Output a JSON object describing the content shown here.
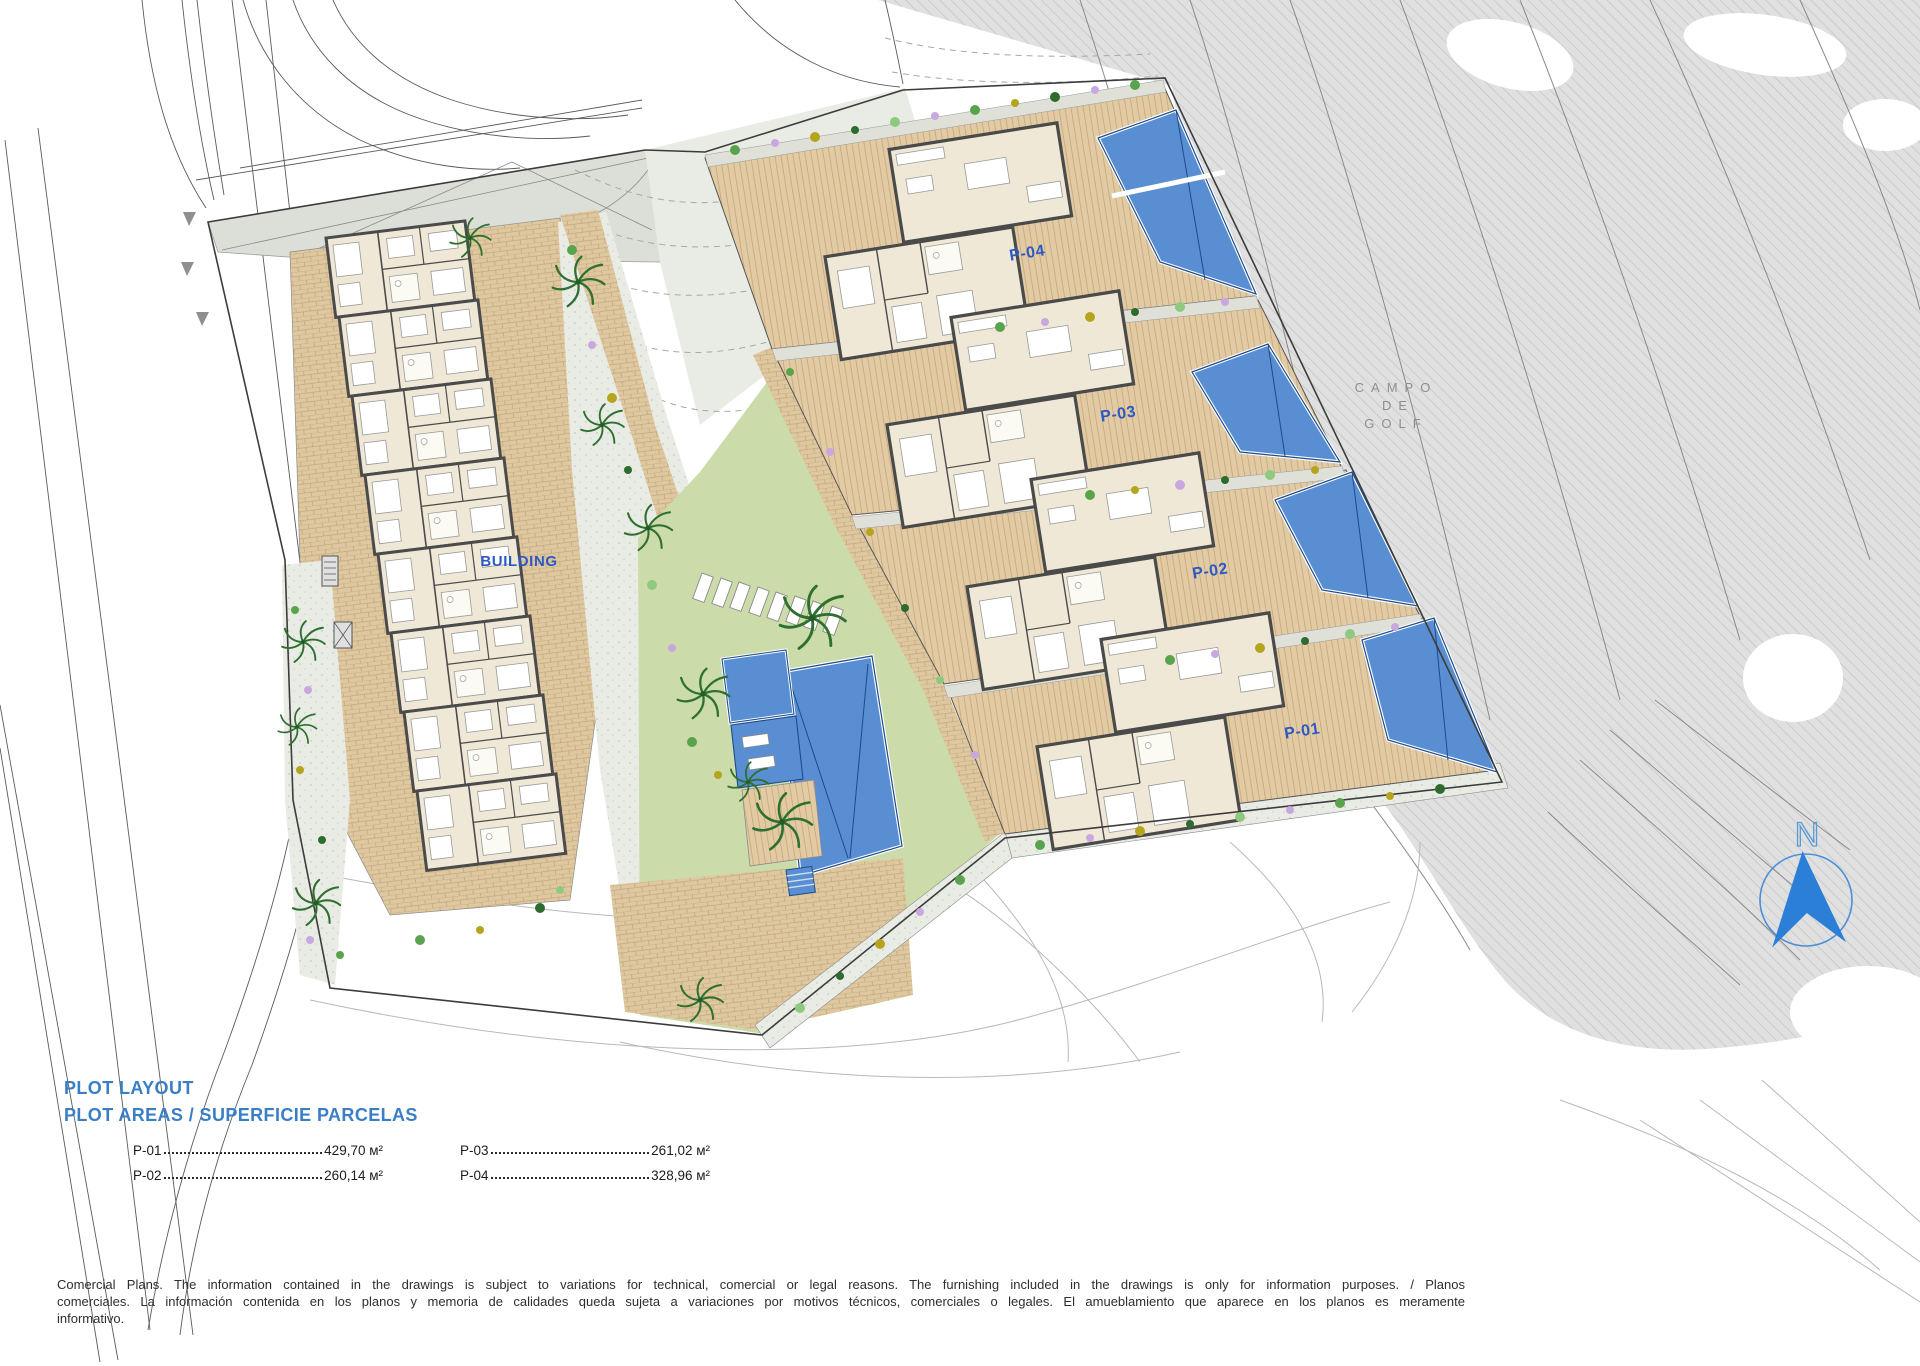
{
  "plan": {
    "building_label": "BUILDING",
    "plot_labels": [
      "P-04",
      "P-03",
      "P-02",
      "P-01"
    ],
    "golf_label": {
      "line1": "CAMPO",
      "line2": "DE",
      "line3": "GOLF"
    },
    "north_label": "N"
  },
  "legend": {
    "title": "PLOT LAYOUT",
    "subtitle": "PLOT AREAS / SUPERFICIE PARCELAS",
    "columns": [
      {
        "rows": [
          {
            "plot": "P-01",
            "area": "429,70 м²"
          },
          {
            "plot": "P-02",
            "area": "260,14 м²"
          }
        ]
      },
      {
        "rows": [
          {
            "plot": "P-03",
            "area": "261,02 м²"
          },
          {
            "plot": "P-04",
            "area": "328,96 м²"
          }
        ]
      }
    ]
  },
  "footer": {
    "disclaimer": "Comercial Plans. The information contained in the drawings is subject to variations for technical, comercial or legal reasons. The furnishing included in the drawings is only for information purposes. / Planos comerciales. La información contenida en los planos y memoria de calidades queda sujeta a variaciones por motivos técnicos, comerciales o legales. El amueblamiento que aparece en los planos es meramente informativo."
  },
  "colors": {
    "label_blue": "#2d59c4",
    "title_blue": "#3a7ec5",
    "pool_blue": "#5a8ed2",
    "compass_blue": "#2b7fd6",
    "deck_tan": "#e2cba4",
    "lawn_green": "#cbdcaa",
    "golf_gray": "#e0e0e0"
  }
}
